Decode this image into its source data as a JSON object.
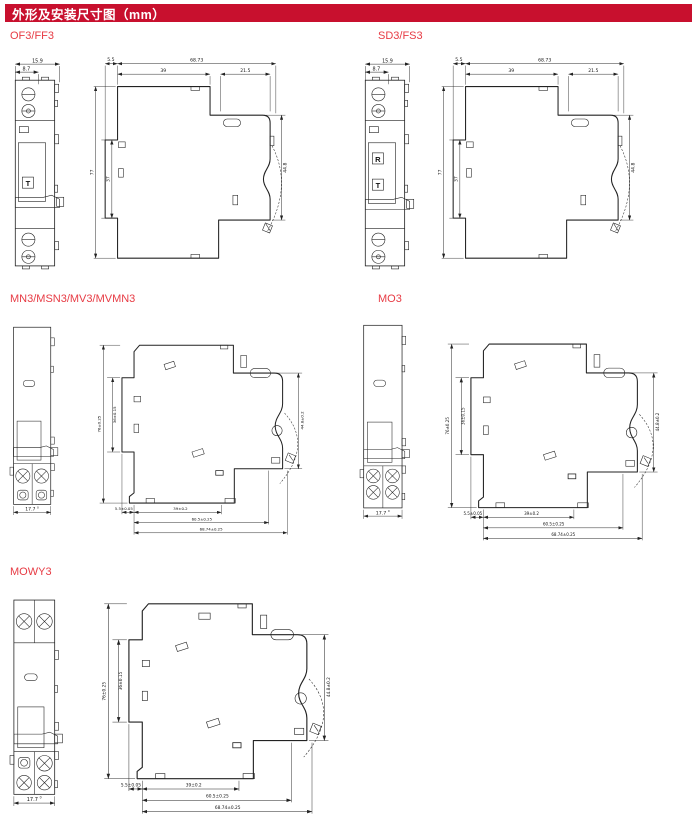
{
  "header": {
    "title": "外形及安装尺寸图（mm）"
  },
  "colors": {
    "banner_bg": "#c8102e",
    "banner_text": "#ffffff",
    "section_title": "#e73b44",
    "line": "#222222"
  },
  "sections": {
    "of3ff3": {
      "title": "OF3/FF3",
      "front": {
        "width": "15.9",
        "width_inner": "8.7",
        "mark_t": "T"
      },
      "side": {
        "rail_depth": "5.5",
        "total_depth": "68.73",
        "body_depth": "39",
        "front_depth": "21.5",
        "height": "77",
        "rail_height": "37",
        "front_height": "44.8"
      }
    },
    "sd3fs3": {
      "title": "SD3/FS3",
      "front": {
        "width": "15.9",
        "width_inner": "8.7",
        "mark_r": "R",
        "mark_t": "T"
      },
      "side": {
        "rail_depth": "5.5",
        "total_depth": "68.73",
        "body_depth": "39",
        "front_depth": "21.5",
        "height": "77",
        "rail_height": "37",
        "front_height": "44.8"
      }
    },
    "mn3": {
      "title": "MN3/MSN3/MV3/MVMN3",
      "front": {
        "pitch": "17.7",
        "pitch_tol": "0"
      },
      "side": {
        "height": "76±0.25",
        "rail_height": "36±0.15",
        "front_height": "44.8±0.2",
        "rail_depth": "5.5±0.05",
        "body_depth": "39±0.2",
        "mid_depth": "60.5±0.25",
        "total_depth": "68.74±0.25"
      }
    },
    "mo3": {
      "title": "MO3",
      "front": {
        "pitch": "17.7",
        "pitch_tol": "0"
      },
      "side": {
        "height": "76±0.25",
        "rail_height": "36±0.15",
        "front_height": "44.8±0.2",
        "rail_depth": "5.5±0.05",
        "body_depth": "39±0.2",
        "mid_depth": "60.5±0.25",
        "total_depth": "68.74±0.25"
      }
    },
    "mowy3": {
      "title": "MOWY3",
      "front": {
        "pitch": "17.7",
        "pitch_tol": "0"
      },
      "side": {
        "height": "76±0.25",
        "rail_height": "36±0.15",
        "front_height": "44.8±0.2",
        "rail_depth": "5.5±0.05",
        "body_depth": "39±0.2",
        "mid_depth": "60.5±0.25",
        "total_depth": "68.74±0.25"
      }
    }
  }
}
